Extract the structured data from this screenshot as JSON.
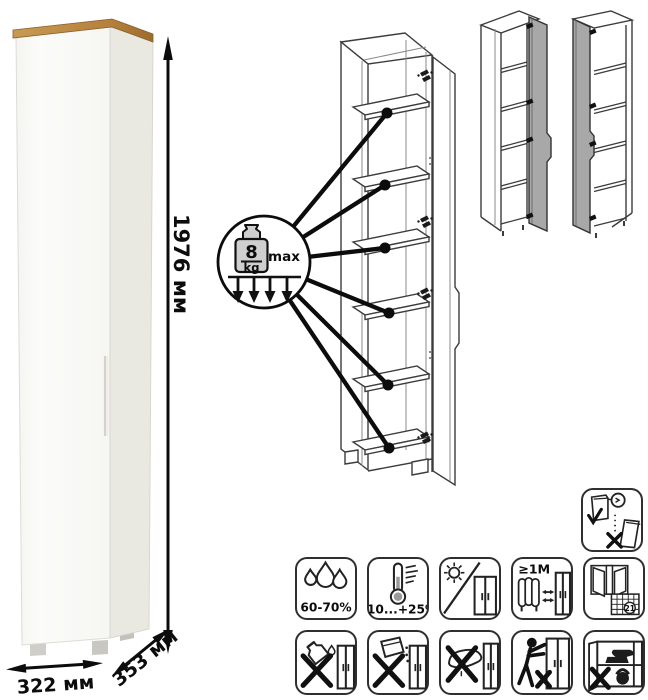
{
  "product": {
    "dimensions": {
      "height": "1976 мм",
      "width": "322 мм",
      "depth": "353 мм"
    }
  },
  "shelf_load": {
    "value": "8",
    "unit": "kg",
    "qualifier": "max"
  },
  "care": {
    "humidity": "60-70%",
    "temperature": "+10...+25⁰C",
    "heat_distance": "≥1М",
    "calendar_day": "21"
  },
  "colors": {
    "wood_top": "#b5803c",
    "cabinet_front": "#f9f9f6",
    "cabinet_side": "#e9e8e1",
    "variant_door_gray": "#a8a8a8",
    "callout_line": "#0c0c0c"
  }
}
